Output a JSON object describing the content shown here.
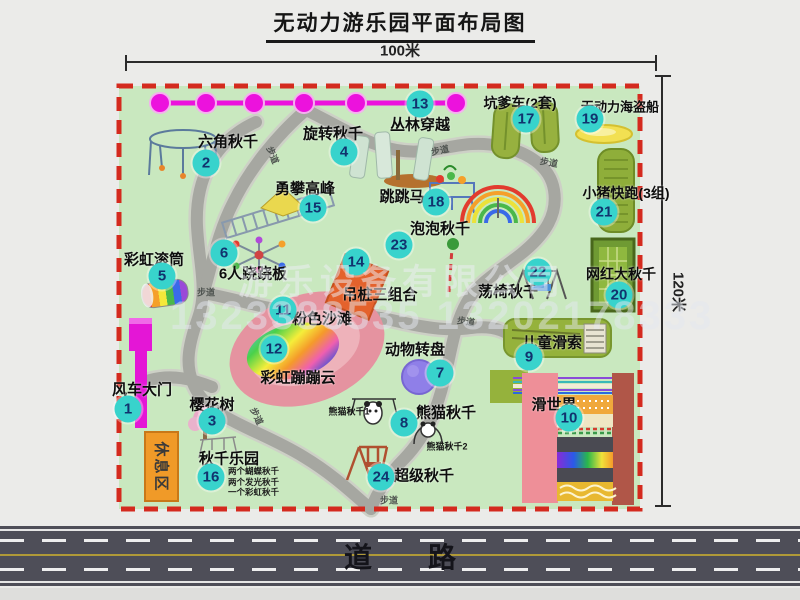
{
  "title": "无动力游乐园平面布局图",
  "dimensions": {
    "width_label": "100米",
    "height_label": "120米"
  },
  "road": {
    "label": "道路"
  },
  "rest_area": {
    "label": "休息区"
  },
  "watermark": {
    "company": "游乐设备有限公司",
    "phone": "1323388535 13202178333"
  },
  "attractions": [
    {
      "num": 1,
      "name": "风车大门",
      "marker": {
        "x": 128,
        "y": 409
      },
      "label": {
        "x": 142,
        "y": 389
      }
    },
    {
      "num": 2,
      "name": "六角秋千",
      "marker": {
        "x": 206,
        "y": 163
      },
      "label": {
        "x": 228,
        "y": 141
      }
    },
    {
      "num": 3,
      "name": "樱花树",
      "marker": {
        "x": 212,
        "y": 421
      },
      "label": {
        "x": 212,
        "y": 404
      }
    },
    {
      "num": 4,
      "name": "旋转秋千",
      "marker": {
        "x": 344,
        "y": 152
      },
      "label": {
        "x": 333,
        "y": 133
      }
    },
    {
      "num": 5,
      "name": "彩虹滚筒",
      "marker": {
        "x": 162,
        "y": 276
      },
      "label": {
        "x": 154,
        "y": 259
      }
    },
    {
      "num": 6,
      "name": "6人跷跷板",
      "marker": {
        "x": 224,
        "y": 253
      },
      "label": {
        "x": 253,
        "y": 273
      }
    },
    {
      "num": 7,
      "name": "动物转盘",
      "marker": {
        "x": 440,
        "y": 373
      },
      "label": {
        "x": 415,
        "y": 349
      }
    },
    {
      "num": 8,
      "name": "熊猫秋千",
      "marker": {
        "x": 404,
        "y": 423
      },
      "label": {
        "x": 446,
        "y": 412
      }
    },
    {
      "num": 9,
      "name": "儿童滑索",
      "marker": {
        "x": 529,
        "y": 357
      },
      "label": {
        "x": 552,
        "y": 342
      }
    },
    {
      "num": 10,
      "name": "滑世界",
      "marker": {
        "x": 569,
        "y": 418
      },
      "label": {
        "x": 554,
        "y": 404
      }
    },
    {
      "num": 11,
      "name": "粉色沙滩",
      "marker": {
        "x": 283,
        "y": 310
      },
      "label": {
        "x": 322,
        "y": 318
      }
    },
    {
      "num": 12,
      "name": "彩虹蹦蹦云",
      "marker": {
        "x": 274,
        "y": 349
      },
      "label": {
        "x": 298,
        "y": 377
      }
    },
    {
      "num": 13,
      "name": "丛林穿越",
      "marker": {
        "x": 420,
        "y": 104
      },
      "label": {
        "x": 420,
        "y": 124
      }
    },
    {
      "num": 14,
      "name": "吊桩三组合",
      "marker": {
        "x": 356,
        "y": 262
      },
      "label": {
        "x": 380,
        "y": 294
      }
    },
    {
      "num": 15,
      "name": "勇攀高峰",
      "marker": {
        "x": 313,
        "y": 208
      },
      "label": {
        "x": 305,
        "y": 188
      }
    },
    {
      "num": 16,
      "name": "秋千乐园",
      "marker": {
        "x": 211,
        "y": 477
      },
      "label": {
        "x": 229,
        "y": 458
      }
    },
    {
      "num": 17,
      "name": "坑爹车(2套)",
      "marker": {
        "x": 526,
        "y": 119
      },
      "label": {
        "x": 520,
        "y": 103,
        "fs": 14
      }
    },
    {
      "num": 18,
      "name": "跳跳马",
      "marker": {
        "x": 436,
        "y": 202
      },
      "label": {
        "x": 402,
        "y": 196
      }
    },
    {
      "num": 19,
      "name": "无动力海盗船",
      "marker": {
        "x": 590,
        "y": 119
      },
      "label": {
        "x": 620,
        "y": 106,
        "fs": 13
      }
    },
    {
      "num": 20,
      "name": "网红大秋千",
      "marker": {
        "x": 619,
        "y": 295
      },
      "label": {
        "x": 621,
        "y": 274,
        "fs": 14
      }
    },
    {
      "num": 21,
      "name": "小猪快跑(3组)",
      "marker": {
        "x": 604,
        "y": 212
      },
      "label": {
        "x": 626,
        "y": 193,
        "fs": 14
      }
    },
    {
      "num": 22,
      "name": "荡椅秋千",
      "marker": {
        "x": 538,
        "y": 272
      },
      "label": {
        "x": 508,
        "y": 291
      }
    },
    {
      "num": 23,
      "name": "泡泡秋千",
      "marker": {
        "x": 399,
        "y": 245
      },
      "label": {
        "x": 440,
        "y": 228
      }
    },
    {
      "num": 24,
      "name": "超级秋千",
      "marker": {
        "x": 381,
        "y": 477
      },
      "label": {
        "x": 424,
        "y": 475
      }
    }
  ],
  "path_labels": [
    {
      "text": "步道",
      "x": 273,
      "y": 155,
      "rot": 68
    },
    {
      "text": "步道",
      "x": 440,
      "y": 150,
      "rot": -12
    },
    {
      "text": "步道",
      "x": 549,
      "y": 162,
      "rot": 10
    },
    {
      "text": "步道",
      "x": 206,
      "y": 292,
      "rot": 0
    },
    {
      "text": "步道",
      "x": 466,
      "y": 321,
      "rot": 8
    },
    {
      "text": "步道",
      "x": 257,
      "y": 416,
      "rot": 65
    },
    {
      "text": "步道",
      "x": 389,
      "y": 500,
      "rot": 0
    }
  ],
  "sub_labels": [
    {
      "text": "熊猫秋千1",
      "x": 349,
      "y": 411
    },
    {
      "text": "熊猫秋千2",
      "x": 447,
      "y": 446
    }
  ],
  "swing_park_notes": [
    "两个蝴蝶秋千",
    "两个发光秋千",
    "一个彩虹秋千"
  ]
}
